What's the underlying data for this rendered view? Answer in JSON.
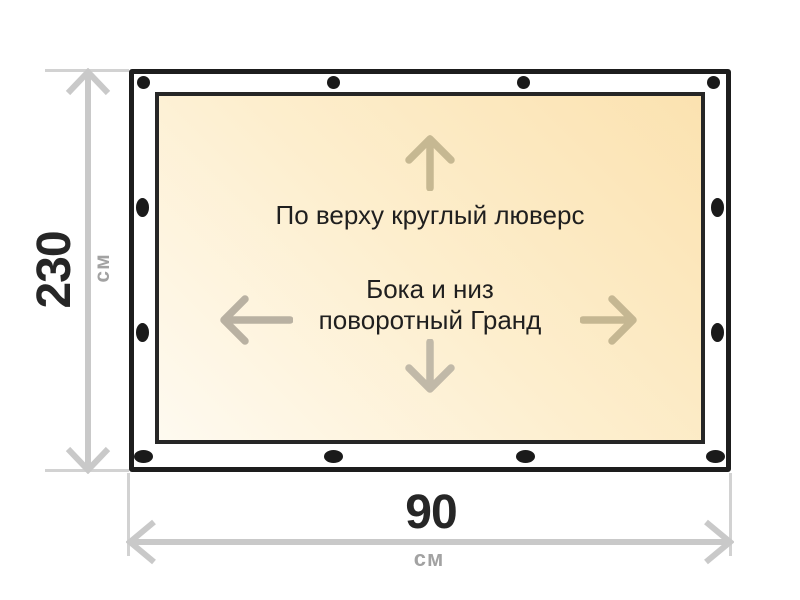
{
  "diagram": {
    "height_dimension": {
      "value": "230",
      "unit": "см"
    },
    "width_dimension": {
      "value": "90",
      "unit": "см"
    },
    "panel_notes": {
      "top": "По верху круглый люверс",
      "sides_line1": "Бока и низ",
      "sides_line2": "поворотный Гранд"
    },
    "grommets": {
      "total": 12,
      "top": 4,
      "bottom": 4,
      "left": 2,
      "right": 2,
      "color": "#1a1a1a"
    },
    "arrow_icons": {
      "up": {
        "icon": "arrow-up-icon",
        "color": "#c6b892"
      },
      "down": {
        "icon": "arrow-down-icon",
        "color": "#c1b9a8"
      },
      "left": {
        "icon": "arrow-left-icon",
        "color": "#b9b1a2"
      },
      "right": {
        "icon": "arrow-right-icon",
        "color": "#c5b792"
      }
    },
    "colors": {
      "outer_border": "#1d1d1d",
      "inner_border": "#262626",
      "panel_gradient_start": "#fefaf0",
      "panel_gradient_end": "#fbe2b0",
      "dimension_line": "#c9c9c9",
      "extension_line": "#d2d2d2",
      "dimension_value_text": "#262626",
      "dimension_unit_text": "#a2a2a2",
      "note_text": "#1f1f1f",
      "background": "#ffffff"
    }
  }
}
